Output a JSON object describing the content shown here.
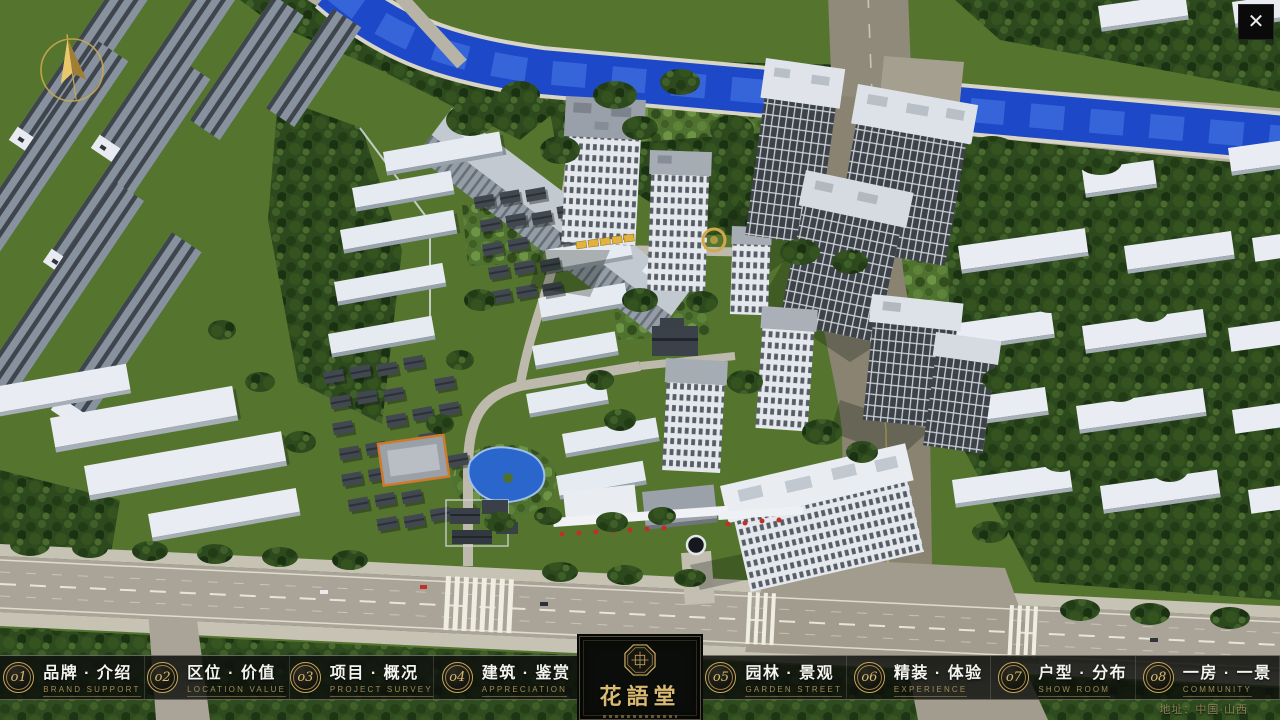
{
  "window": {
    "close_label": "✕"
  },
  "logo": {
    "title": "花語堂"
  },
  "navbar": {
    "address": "地址：中国·山西",
    "items": [
      {
        "num": "o1",
        "cn": "品牌 · 介绍",
        "en": "BRAND SUPPORT"
      },
      {
        "num": "o2",
        "cn": "区位 · 价值",
        "en": "LOCATION VALUE"
      },
      {
        "num": "o3",
        "cn": "项目 · 概况",
        "en": "PROJECT SURVEY"
      },
      {
        "num": "o4",
        "cn": "建筑 · 鉴赏",
        "en": "APPRECIATION"
      },
      {
        "num": "o5",
        "cn": "园林 · 景观",
        "en": "GARDEN STREET"
      },
      {
        "num": "o6",
        "cn": "精装 · 体验",
        "en": "EXPERIENCE"
      },
      {
        "num": "o7",
        "cn": "户型 · 分布",
        "en": "SHOW ROOM"
      },
      {
        "num": "o8",
        "cn": "一房 · 一景",
        "en": "COMMUNITY"
      }
    ]
  },
  "palette": {
    "gold": "#c9a85c",
    "nav_background": "#0d0f0c",
    "river_blue": "#1d49c8",
    "grass_green": "#55752f",
    "road_gray": "#a9a497"
  }
}
